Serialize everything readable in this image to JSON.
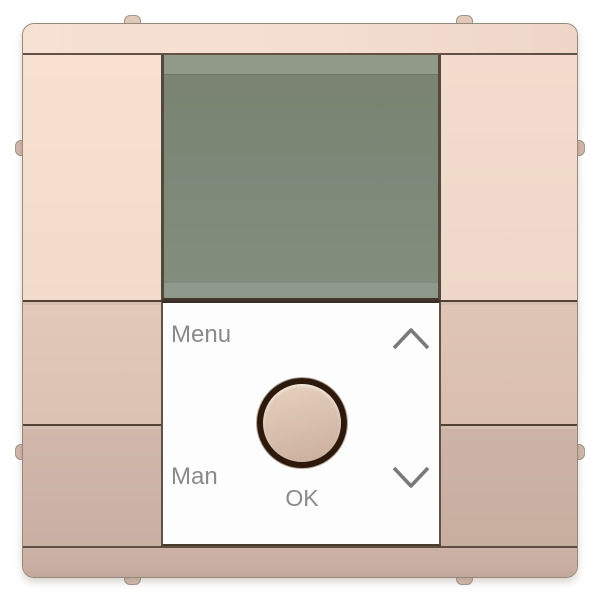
{
  "panel": {
    "menu_label": "Menu",
    "man_label": "Man",
    "ok_label": "OK"
  },
  "icons": {
    "up_icon": "chevron-up",
    "down_icon": "chevron-down"
  },
  "colors": {
    "frame_top": "#f5dfd1",
    "frame_bottom": "#c9b0a3",
    "button_upper_left": "#f8e0d1",
    "button_upper_right": "#f2dccd",
    "button_middle": "#dfc5b5",
    "button_lower": "#cdb4a7",
    "display_body": "#7f897b",
    "display_band_top": "#909a87",
    "display_band_bottom": "#8e988b",
    "panel_background": "#fdfdfd",
    "label_text": "#8a8a8a",
    "chevron": "#7a7a7a",
    "knob_ring": "#2c190c",
    "knob_fill": "#d6bcab"
  }
}
